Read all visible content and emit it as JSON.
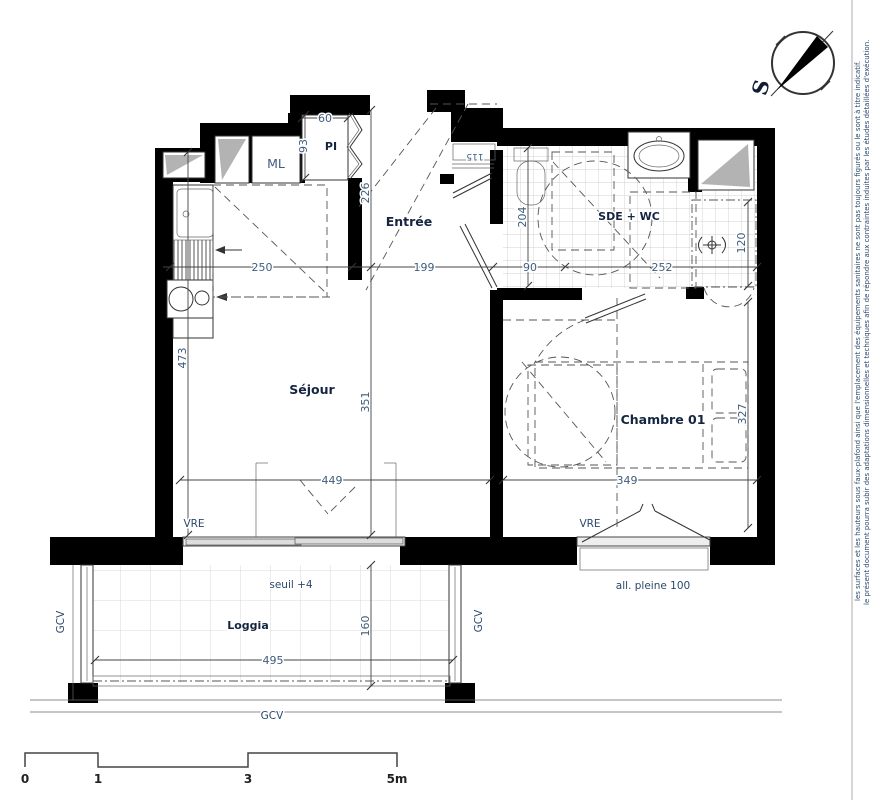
{
  "rooms": {
    "entree": "Entrée",
    "sejour": "Séjour",
    "sde_wc": "SDE + WC",
    "chambre": "Chambre 01",
    "loggia": "Loggia",
    "pi": "PI",
    "ml": "ML"
  },
  "dimensions": {
    "pi_width": "60",
    "pi_depth": "93",
    "entree_depth": "226",
    "kitchen_width": "250",
    "entree_width": "199",
    "door_width": "115",
    "sde_depth": "204",
    "sde_w1": "90",
    "sde_w2": "252",
    "shower_depth": "120",
    "sejour_depth": "473",
    "sejour_mid_depth": "351",
    "sejour_width": "449",
    "chambre_width": "349",
    "chambre_depth": "327",
    "loggia_width": "495",
    "loggia_depth": "160"
  },
  "annotations": {
    "vre_sejour": "VRE",
    "vre_chambre": "VRE",
    "seuil": "seuil +4",
    "allege": "all. pleine 100",
    "gcv_left": "GCV",
    "gcv_right": "GCV",
    "gcv_bottom": "GCV"
  },
  "scale_bar": {
    "t0": "0",
    "t1": "1",
    "t3": "3",
    "t5": "5m"
  },
  "compass": {
    "south": "S"
  },
  "disclaimer": {
    "line1": "le présent document pourra subir des adaptations dimensionnelles et techniques afin de répondre aux contraintes induites par les études détaillées d'exécution.",
    "line2": "les surfaces et les hauteurs sous faux-plafond ainsi que l'emplacement des équipements sanitaires ne sont pas toujours figurés ou le sont à titre indicatif."
  },
  "colors": {
    "wall": "#000000",
    "dim_text": "#3f5c7d",
    "label_text": "#152540",
    "window_gray": "#b3b3b3",
    "tile_line": "#c4c4c4"
  }
}
